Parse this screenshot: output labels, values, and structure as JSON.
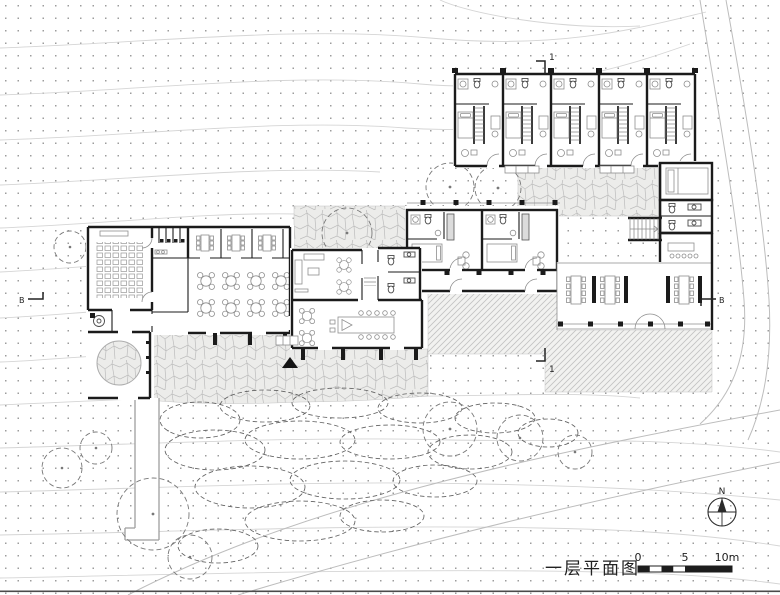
{
  "drawing": {
    "caption": "一层平面图",
    "scale_bar": {
      "labels": [
        "0",
        "5",
        "10m"
      ],
      "unit": "m",
      "max_value": 10
    },
    "compass": {
      "north_label": "N"
    },
    "section_markers": {
      "top": "1",
      "bottom": "1",
      "left": "B",
      "right": "B"
    },
    "colors": {
      "wall": "#1b1b1b",
      "furniture": "#8e8e8e",
      "paving_line": "#bcbcbc",
      "hatch_line": "#c2c2c2",
      "terrain_dot": "#9c9c9c",
      "contour": "#d5d5d5",
      "vegetation": "#616161"
    }
  }
}
